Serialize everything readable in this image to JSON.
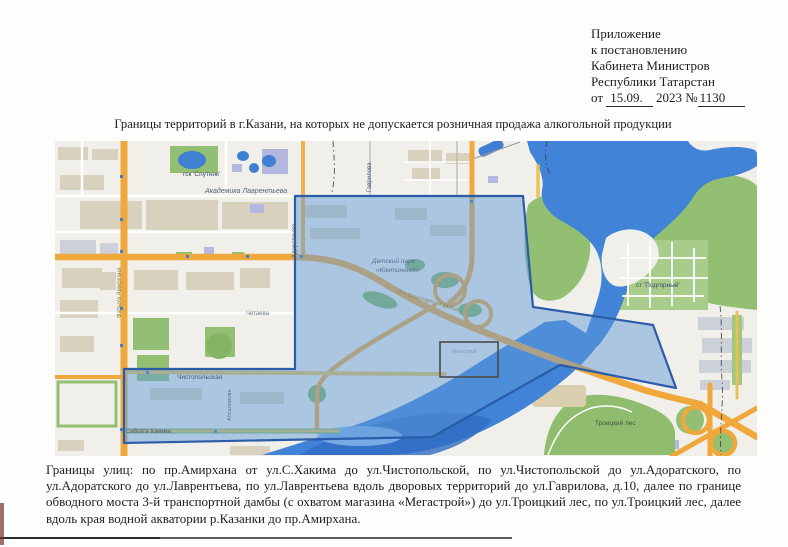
{
  "header": {
    "lines": [
      "Приложение",
      "к постановлению",
      "Кабинета Министров",
      "Республики Татарстан"
    ],
    "date_line": {
      "prefix": "от ",
      "date": "15.09.",
      "middle": " 2023 №",
      "number": "1130"
    }
  },
  "title": "Границы территорий в г.Казани, на которых не допускается розничная продажа алкогольной продукции",
  "description": "Границы улиц: по пр.Амирхана от ул.С.Хакима до ул.Чистопольской, по ул.Чистопольской до ул.Адоратского, по ул.Адоратского до ул.Лаврентьева, по ул.Лаврентьева вдоль дворовых территорий до ул.Гаврилова, д.10, далее по границе обводного моста 3-й транспортной дамбы (с охватом магазина «Мегастрой») до ул.Троицкий лес, по ул.Троицкий лес, далее вдоль края водной акватории р.Казанки до пр.Амирхана.",
  "map": {
    "labels": {
      "gsk_sputnik": "гск 'Спутник'",
      "akademika_lavrentieva": "Академика Лаврентьева",
      "chetaeva": "Четаева",
      "detsky_park_line1": "Детский парк",
      "detsky_park_line2": "«Континент»",
      "st_podgorny": "ст 'Подгорный'",
      "troitsky_les": "Троицкий лес",
      "chistopolskaya": "Чистопольская",
      "sibgata_khakima": "Сибгата Хакима",
      "fatykha_amirkhana": "Фатыха Амирхана",
      "adoratskogo": "Адоратского",
      "gavrilova": "Гаврилова",
      "absalyamova": "Абсалямова",
      "transport_dam": "3-я транспортная дамба",
      "megastroy": "Мегастрой"
    },
    "colors": {
      "water": "#4183d6",
      "park_green": "#93bf72",
      "road_orange": "#f0a83d",
      "road_yellow": "#e9c257",
      "restricted_zone_fill": "#5e9ad8",
      "restricted_zone_border": "#2a5ca8"
    }
  }
}
